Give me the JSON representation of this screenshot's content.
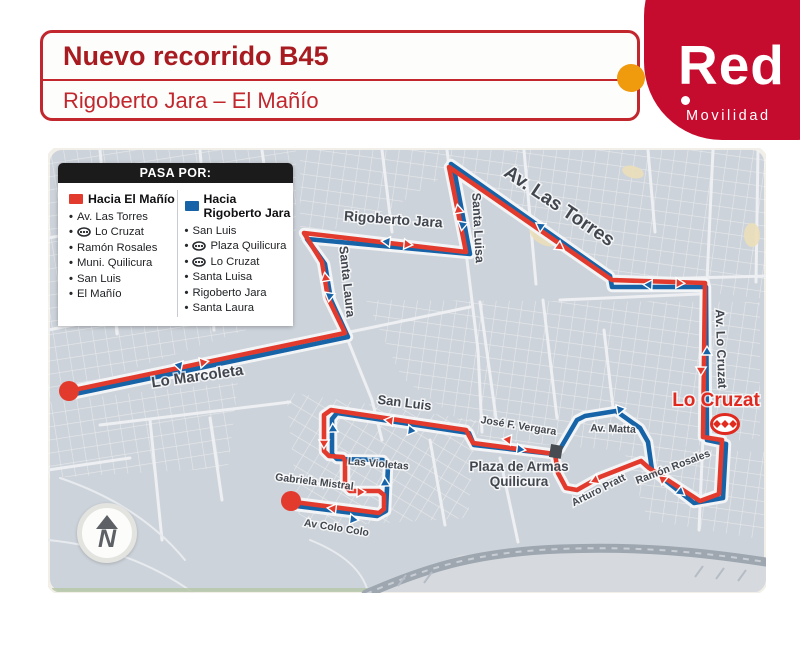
{
  "header": {
    "title": "Nuevo recorrido B45",
    "subtitle": "Rigoberto Jara – El Mañío"
  },
  "logo": {
    "brand": "Red",
    "tagline": "Movilidad",
    "red": "#c60c2e",
    "orange": "#f09a0e"
  },
  "legend": {
    "header": "PASA POR:",
    "bullet": "•",
    "columns": [
      {
        "title": "Hacia El Mañío",
        "color": "#e23b2e",
        "items": [
          {
            "label": "Av. Las Torres",
            "metro": false
          },
          {
            "label": "Lo Cruzat",
            "metro": true
          },
          {
            "label": "Ramón Rosales",
            "metro": false
          },
          {
            "label": "Muni. Quilicura",
            "metro": false
          },
          {
            "label": "San Luis",
            "metro": false
          },
          {
            "label": "El Mañío",
            "metro": false
          }
        ]
      },
      {
        "title": "Hacia Rigoberto Jara",
        "color": "#1763a8",
        "items": [
          {
            "label": "San Luis",
            "metro": false
          },
          {
            "label": "Plaza Quilicura",
            "metro": true
          },
          {
            "label": "Lo Cruzat",
            "metro": true
          },
          {
            "label": "Santa Luisa",
            "metro": false
          },
          {
            "label": "Rigoberto Jara",
            "metro": false
          },
          {
            "label": "Santa Laura",
            "metro": false
          }
        ]
      }
    ]
  },
  "map": {
    "compass_letter": "N",
    "station": {
      "name": "Lo Cruzat"
    },
    "colors": {
      "red": "#e23b2e",
      "blue": "#1763a8",
      "bg": "#cdd3da",
      "label": "#42474f"
    },
    "routes": {
      "red_d": "M69 391 L345 333 328 298 322 262 304 233 466 252 449 167 612 280 705 283 703 437 722 440 719 494 700 501 649 468 641 461 600 477 577 490 566 488 558 473 555 454 473 443 466 430 331 410 324 415 324 451 329 456 343 457 345 461 345 486 350 491 379 491 384 495 384 509 379 513 294 502",
      "blue_d": "M296 506 L377 516 386 511 388 466 383 460 337 459 332 454 332 419 337 413 469 433 474 445 553 454 560 449 577 420 585 416 616 411 640 428 648 442 652 470 694 503 723 498 726 444 707 440 706 287 612 287 610 276 451 164 454 169 470 254 307 239 325 264 331 300 348 337 70 395"
    },
    "terminals": [
      {
        "x": 69,
        "y": 391
      },
      {
        "x": 291,
        "y": 501
      }
    ],
    "arrows": [
      {
        "x": 182,
        "y": 366,
        "r": 192,
        "c": "blue"
      },
      {
        "x": 330,
        "y": 293,
        "r": 99,
        "c": "blue"
      },
      {
        "x": 390,
        "y": 242,
        "r": 186,
        "c": "blue"
      },
      {
        "x": 463,
        "y": 222,
        "r": 100,
        "c": "blue"
      },
      {
        "x": 543,
        "y": 228,
        "r": 215,
        "c": "blue"
      },
      {
        "x": 652,
        "y": 285,
        "r": 183,
        "c": "blue"
      },
      {
        "x": 707,
        "y": 355,
        "r": 270,
        "c": "blue"
      },
      {
        "x": 617,
        "y": 410,
        "r": 350,
        "c": "blue"
      },
      {
        "x": 678,
        "y": 490,
        "r": 39,
        "c": "blue"
      },
      {
        "x": 517,
        "y": 449,
        "r": 7,
        "c": "blue"
      },
      {
        "x": 408,
        "y": 430,
        "r": 8,
        "c": "blue"
      },
      {
        "x": 333,
        "y": 432,
        "r": 268,
        "c": "blue"
      },
      {
        "x": 385,
        "y": 486,
        "r": 268,
        "c": "blue"
      },
      {
        "x": 350,
        "y": 519,
        "r": 8,
        "c": "blue"
      },
      {
        "x": 200,
        "y": 363,
        "r": 349,
        "c": "red"
      },
      {
        "x": 326,
        "y": 281,
        "r": 261,
        "c": "red"
      },
      {
        "x": 404,
        "y": 244,
        "r": 6,
        "c": "red"
      },
      {
        "x": 459,
        "y": 213,
        "r": 259,
        "c": "red"
      },
      {
        "x": 557,
        "y": 245,
        "r": 35,
        "c": "red"
      },
      {
        "x": 676,
        "y": 283,
        "r": 2,
        "c": "red"
      },
      {
        "x": 701,
        "y": 367,
        "r": 91,
        "c": "red"
      },
      {
        "x": 665,
        "y": 481,
        "r": 218,
        "c": "red"
      },
      {
        "x": 598,
        "y": 479,
        "r": 157,
        "c": "red"
      },
      {
        "x": 511,
        "y": 440,
        "r": 187,
        "c": "red"
      },
      {
        "x": 393,
        "y": 421,
        "r": 188,
        "c": "red"
      },
      {
        "x": 324,
        "y": 440,
        "r": 91,
        "c": "red"
      },
      {
        "x": 357,
        "y": 492,
        "r": 0,
        "c": "red"
      },
      {
        "x": 336,
        "y": 509,
        "r": 187,
        "c": "red"
      }
    ],
    "labels": [
      {
        "text": "Rigoberto Jara",
        "x": 393,
        "y": 224,
        "rot": 4,
        "size": 14,
        "weight": 600
      },
      {
        "text": "Santa Luisa",
        "x": 474,
        "y": 228,
        "rot": 87,
        "size": 12.5,
        "weight": 600
      },
      {
        "text": "Av. Las Torres",
        "x": 556,
        "y": 211,
        "rot": 34,
        "size": 19,
        "weight": 700
      },
      {
        "text": "Santa Laura",
        "x": 343,
        "y": 282,
        "rot": 84,
        "size": 12.5,
        "weight": 600
      },
      {
        "text": "Av. Lo Cruzat",
        "x": 717,
        "y": 349,
        "rot": 88,
        "size": 12.5,
        "weight": 600
      },
      {
        "text": "Lo Marcoleta",
        "x": 198,
        "y": 381,
        "rot": -8,
        "size": 15,
        "weight": 600
      },
      {
        "text": "San Luis",
        "x": 404,
        "y": 407,
        "rot": 7,
        "size": 13,
        "weight": 600
      },
      {
        "text": "José F. Vergara",
        "x": 518,
        "y": 429,
        "rot": 9,
        "size": 10.5,
        "weight": 600
      },
      {
        "text": "Av. Matta",
        "x": 613,
        "y": 432,
        "rot": 2,
        "size": 10.5,
        "weight": 600
      },
      {
        "text": "Plaza de Armas",
        "x": 519,
        "y": 471,
        "rot": 0,
        "size": 13.5,
        "weight": 700
      },
      {
        "text": "Quilicura",
        "x": 519,
        "y": 486,
        "rot": 0,
        "size": 13.5,
        "weight": 700
      },
      {
        "text": "Arturo Pratt",
        "x": 600,
        "y": 493,
        "rot": -27,
        "size": 10.5,
        "weight": 600
      },
      {
        "text": "Ramón Rosales",
        "x": 674,
        "y": 470,
        "rot": -21,
        "size": 10.5,
        "weight": 600
      },
      {
        "text": "Las Violetas",
        "x": 378,
        "y": 467,
        "rot": 5,
        "size": 10.5,
        "weight": 600
      },
      {
        "text": "Gabriela Mistral",
        "x": 314,
        "y": 485,
        "rot": 7,
        "size": 10.5,
        "weight": 600
      },
      {
        "text": "Av Colo Colo",
        "x": 336,
        "y": 531,
        "rot": 9,
        "size": 10.5,
        "weight": 600
      },
      {
        "text": "Lo Cruzat",
        "x": 716,
        "y": 406,
        "rot": 0,
        "size": 19,
        "weight": 700,
        "color": "#e02a20"
      }
    ]
  }
}
